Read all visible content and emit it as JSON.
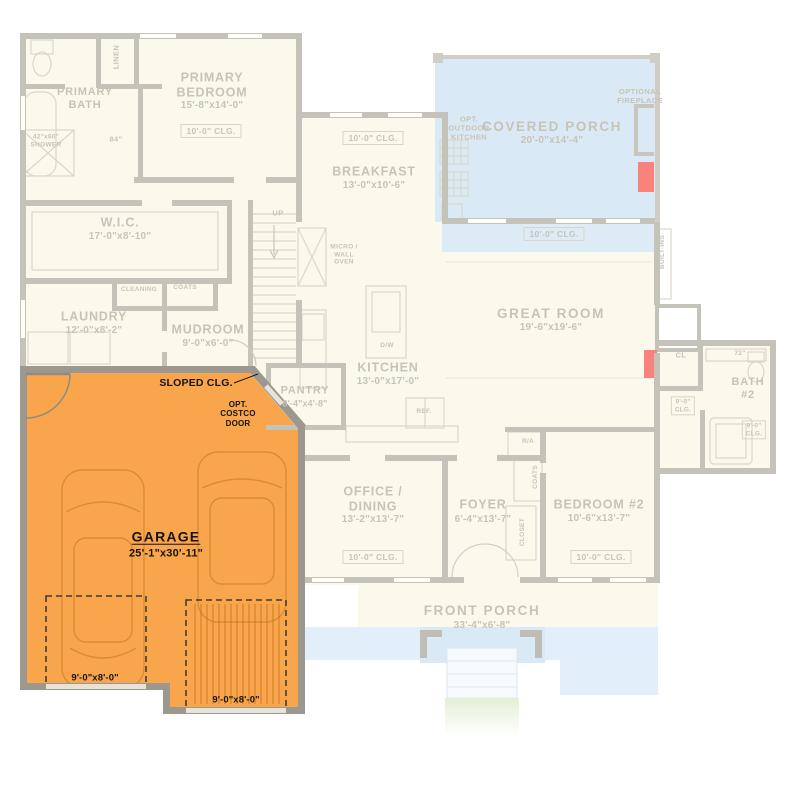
{
  "plan": {
    "highlighted_room": "GARAGE",
    "colors": {
      "background": "#FFFFFF",
      "room_fill": "#FBF9EC",
      "porch_blue": "#D9E9F6",
      "wall_faded": "#C5C2B9",
      "wall_garage": "#9C9890",
      "garage_highlight": "#F9A54C",
      "label_faded": "#C8C4B5",
      "label_black": "#141414",
      "fireplace_red": "#F8837D",
      "grass_green": "#E3EFD5"
    },
    "labels": {
      "linen": "LINEN",
      "primary_bath": "PRIMARY\nBATH",
      "shower": "42\"x60\"\nSHOWER",
      "hall_84": "84\"",
      "primary_bedroom_name": "PRIMARY\nBEDROOM",
      "primary_bedroom_dims": "15'-8\"x14'-0\"",
      "primary_bedroom_clg": "10'-0\" CLG.",
      "wic_name": "W.I.C.",
      "wic_dims": "17'-0\"x8'-10\"",
      "cleaning": "CLEANING",
      "coats_mudroom": "COATS",
      "laundry_name": "LAUNDRY",
      "laundry_dims": "12'-0\"x8'-2\"",
      "mudroom_name": "MUDROOM",
      "mudroom_dims": "9'-0\"x6'-0\"",
      "stairs_up": "UP",
      "micro_wall_oven": "MICRO /\nWALL\nOVEN",
      "breakfast_clg": "10'-0\" CLG.",
      "breakfast_name": "BREAKFAST",
      "breakfast_dims": "13'-0\"x10'-6\"",
      "opt_outdoor_kitchen": "OPT.\nOUTDOOR\nKITCHEN",
      "covered_porch_name": "COVERED PORCH",
      "covered_porch_dims": "20'-0\"x14'-4\"",
      "optional_fireplace": "OPTIONAL\nFIREPLACE",
      "great_room_clg": "10'-0\" CLG.",
      "great_room_name": "GREAT ROOM",
      "great_room_dims": "19'-6\"x19'-6\"",
      "built_ins": "BUILT-INS",
      "kitchen_name": "KITCHEN",
      "kitchen_dims": "13'-0\"x17'-0\"",
      "dishwasher": "D/W",
      "refrigerator": "REF.",
      "pantry_name": "PANTRY",
      "pantry_dims": "8'-4\"x4'-8\"",
      "sloped_clg": "SLOPED CLG.",
      "opt_costco_door": "OPT.\nCOSTCO\nDOOR",
      "garage_name": "GARAGE",
      "garage_dims": "25'-1\"x30'-11\"",
      "garage_door_left": "9'-0\"x8'-0\"",
      "garage_door_right": "9'-0\"x8'-0\"",
      "office_dining_name": "OFFICE /\nDINING",
      "office_dining_dims": "13'-2\"x13'-7\"",
      "office_dining_clg": "10'-0\" CLG.",
      "foyer_name": "FOYER",
      "foyer_dims": "6'-4\"x13'-7\"",
      "return_air": "R/A",
      "coats_foyer": "COATS",
      "closet_foyer": "CLOSET",
      "bedroom2_name": "BEDROOM #2",
      "bedroom2_dims": "10'-6\"x13'-7\"",
      "bedroom2_clg": "10'-0\" CLG.",
      "closet_cl": "CL",
      "bath2_counter": "72\"",
      "bath2_name": "BATH\n#2",
      "bath2_clg_left": "9'-0\"\nCLG.",
      "bath2_clg_right": "9'-0\"\nCLG.",
      "front_porch_name": "FRONT PORCH",
      "front_porch_dims": "33'-4\"x6'-8\""
    }
  }
}
